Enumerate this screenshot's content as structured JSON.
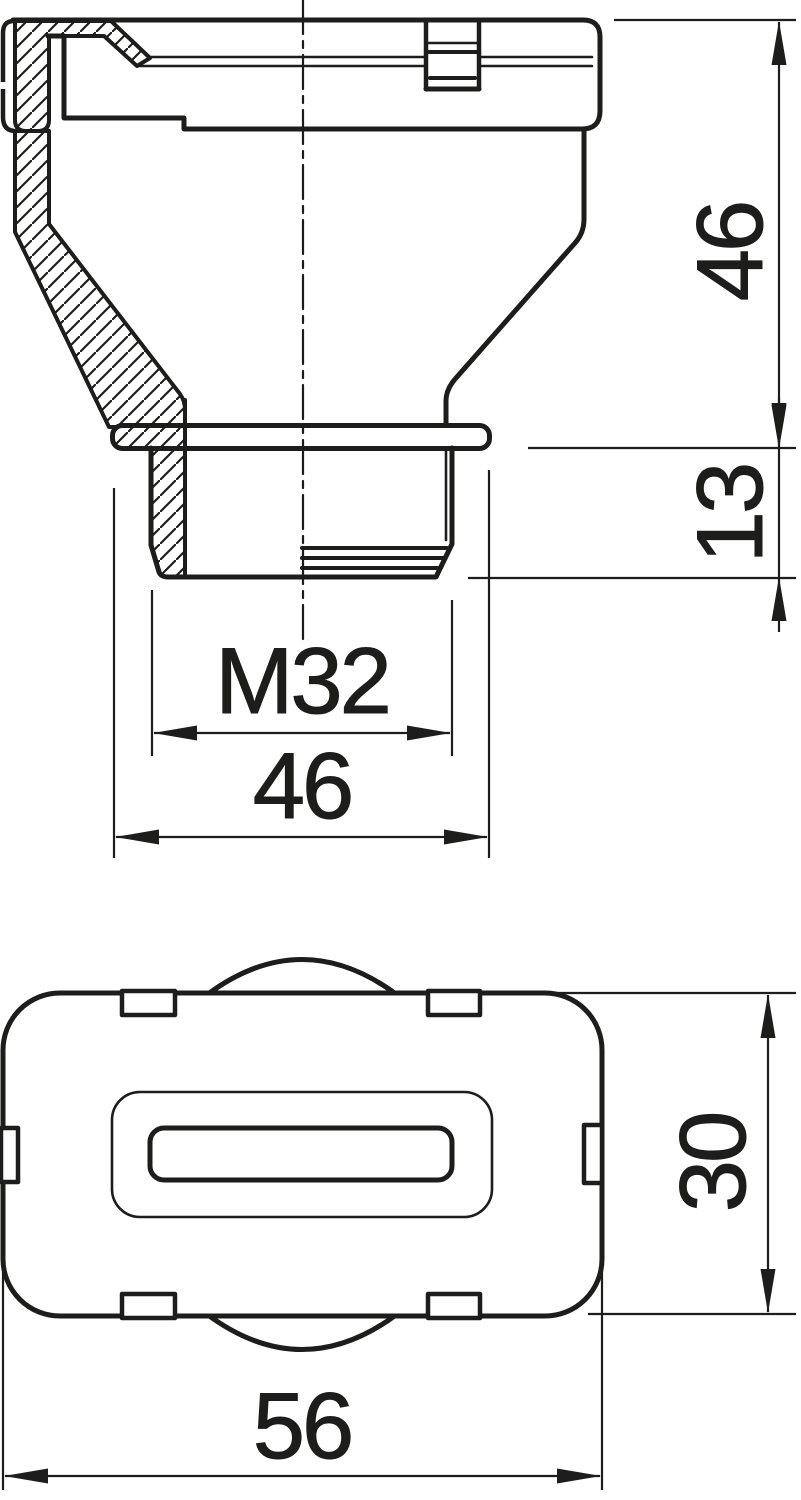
{
  "drawing": {
    "ink": "#1d1d1b",
    "background": "#ffffff",
    "views": {
      "section": {
        "label": "front-section-view"
      },
      "plan": {
        "label": "bottom-plan-view"
      }
    },
    "dims": {
      "side_height": "46",
      "thread_length": "13",
      "thread_size": "M32",
      "flange_width": "46",
      "plan_height": "30",
      "plan_width": "56"
    }
  }
}
